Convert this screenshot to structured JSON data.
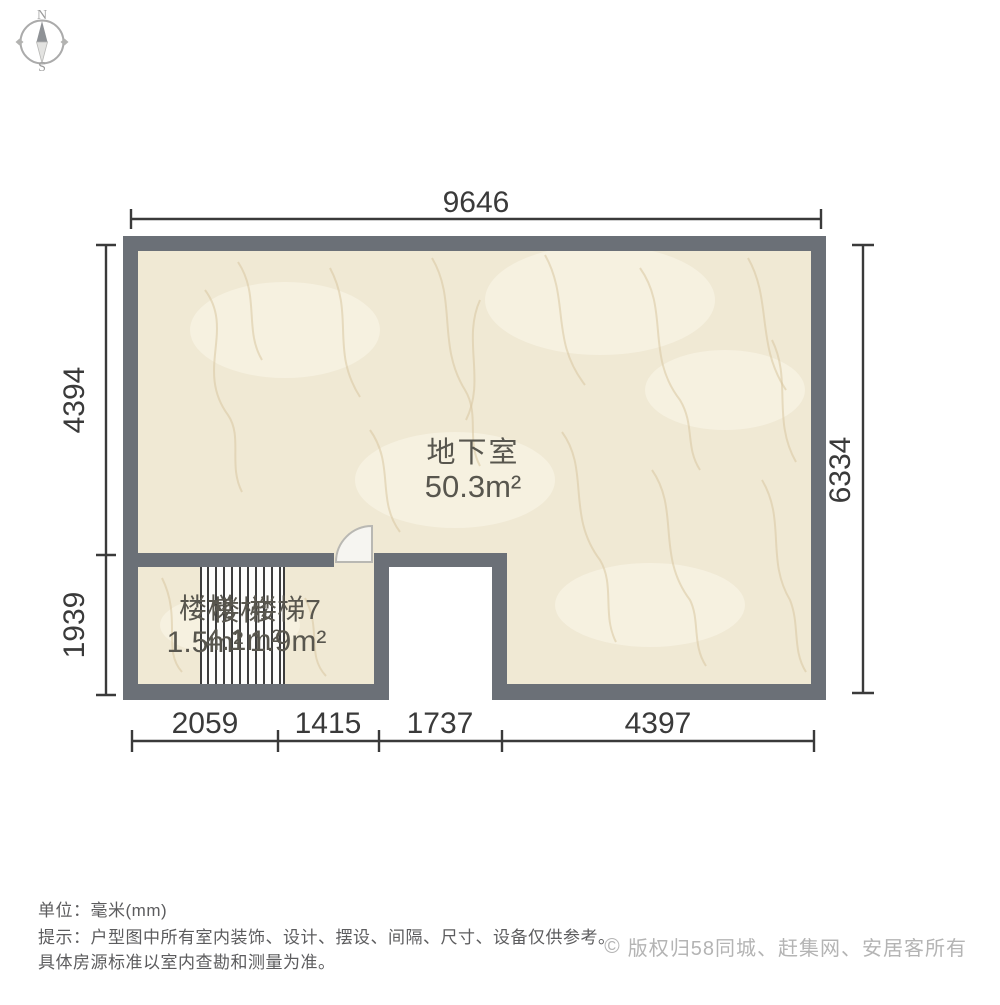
{
  "compass": {
    "north_label": "N",
    "south_label": "S"
  },
  "plan": {
    "room": {
      "name": "地下室",
      "area": "50.3m²"
    },
    "stair_labels": [
      {
        "name": "楼梯",
        "area": "1.5m²"
      },
      {
        "name": "楼梯",
        "area": "4.1m²"
      },
      {
        "name": "楼梯7",
        "area": "1.9m²"
      }
    ],
    "dimensions": {
      "top": "9646",
      "left_upper": "4394",
      "left_lower": "1939",
      "right": "6334",
      "bottom": [
        "2059",
        "1415",
        "1737",
        "4397"
      ]
    },
    "colors": {
      "wall": "#6b7077",
      "floor": "#f0e9d4",
      "dim": "#3a3a3a",
      "label": "#58564e"
    }
  },
  "footer": {
    "unit_line": "单位：毫米(mm)",
    "tip_line1": "提示：户型图中所有室内装饰、设计、摆设、间隔、尺寸、设备仅供参考。",
    "tip_line2": "具体房源标准以室内查勘和测量为准。",
    "copyright_symbol": "©",
    "copyright_text": "版权归58同城、赶集网、安居客所有"
  }
}
